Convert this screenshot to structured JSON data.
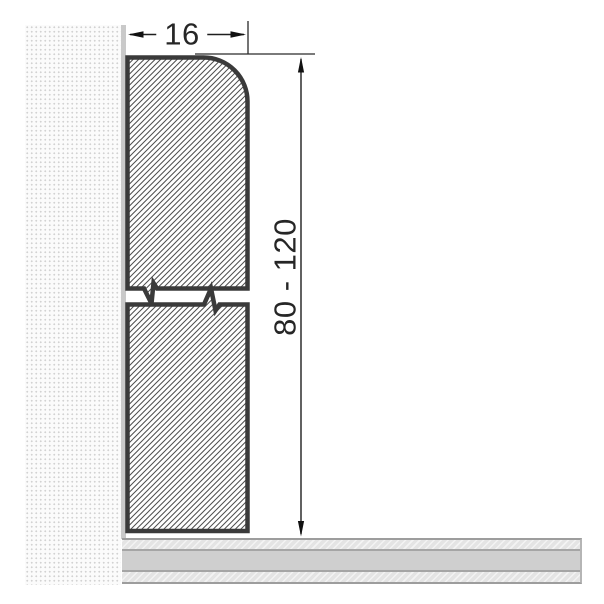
{
  "diagram": {
    "type": "technical cross-section drawing",
    "subject": "skirting-board profile mounted against wall above floor",
    "dimensions": {
      "width_label": "16",
      "height_label": "80 - 120"
    },
    "colors": {
      "profile_outline": "#3a3a3a",
      "profile_hatch_line": "#4d4d4d",
      "dimension_lines": "#1e1e1e",
      "wall_dots": "#d2d2d2",
      "wall_background": "#fbfbfb",
      "wall_edge_strip": "#c9c9c9",
      "floor_solid_band": "#cfcfcf",
      "floor_hatch_band": "#e8e8e8",
      "floor_divider": "#a5a5a5"
    },
    "icons": {
      "arrowheads": "dimension-arrow-icons",
      "break_marks": "zigzag-break-symbol (variable height)"
    }
  }
}
